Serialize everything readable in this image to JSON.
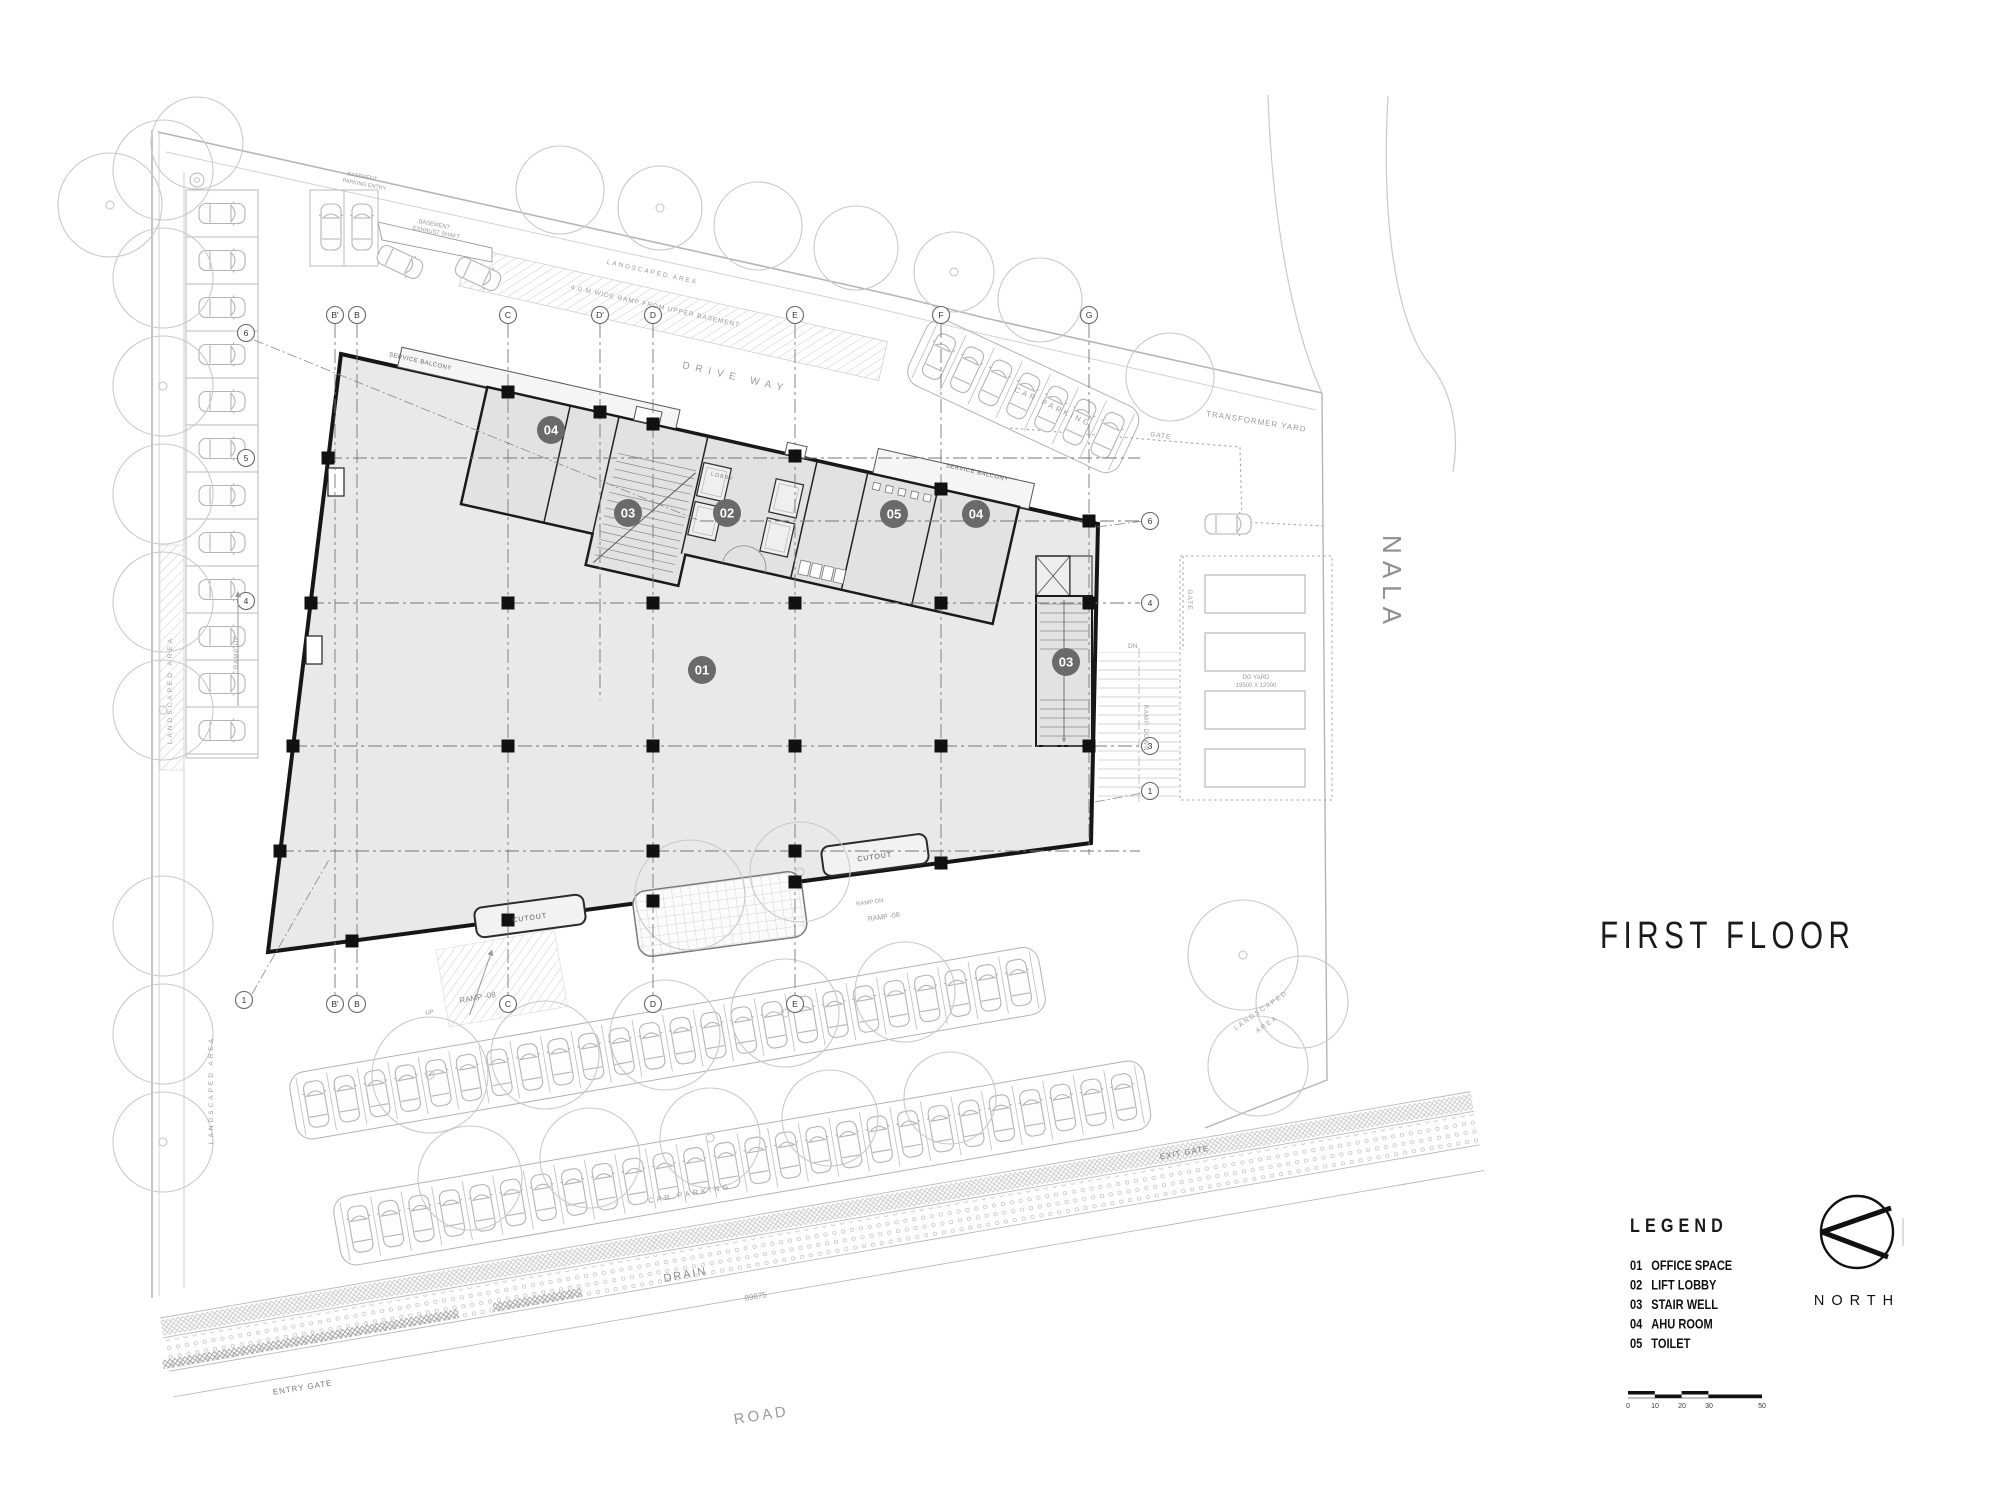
{
  "title": "FIRST FLOOR",
  "legend": {
    "title": "LEGEND",
    "items": [
      {
        "num": "01",
        "label": "OFFICE SPACE"
      },
      {
        "num": "02",
        "label": "LIFT LOBBY"
      },
      {
        "num": "03",
        "label": "STAIR WELL"
      },
      {
        "num": "04",
        "label": "AHU ROOM"
      },
      {
        "num": "05",
        "label": "TOILET"
      }
    ]
  },
  "north": {
    "label": "NORTH"
  },
  "scale_bar": {
    "ticks": [
      "0",
      "10",
      "20",
      "30",
      "50"
    ]
  },
  "grid": {
    "top_letters": [
      "B'",
      "B",
      "C",
      "D'",
      "D",
      "E",
      "F",
      "G"
    ],
    "bottom_letters": [
      "B'",
      "B",
      "C",
      "D",
      "E"
    ],
    "left_numbers": [
      "6",
      "5",
      "4",
      "1"
    ],
    "right_numbers": [
      "6",
      "4",
      "3",
      "1"
    ]
  },
  "room_badges": [
    "04",
    "03",
    "02",
    "05",
    "04",
    "01",
    "03"
  ],
  "labels": {
    "drive_way": "DRIVE WAY",
    "car_parking_top": "CAR PARKING",
    "car_parking_bottom": "CAR PARKING",
    "nala": "NALA",
    "road": "ROAD",
    "drain": "DRAIN",
    "dimension": "89875",
    "entry_gate": "ENTRY GATE",
    "exit_gate": "EXIT GATE",
    "gate_fence": "GATE",
    "gate_side": "GATE",
    "transformer_yard": "TRANSFORMER YARD",
    "dg_yard_1": "DG YARD",
    "dg_yard_2": "19500 X 12000",
    "landscaped_left": "LANDSCAPED AREA",
    "landscaped_lower_left": "LANDSCAPED AREA",
    "landscaped_top": "LANDSCAPED AREA",
    "landscaped_right_1": "LANDSCAPED",
    "landscaped_right_2": "AREA",
    "basement_shaft_1": "BASEMENT",
    "basement_shaft_2": "EXHAUST SHAFT",
    "basement_entry_1": "BASEMENT",
    "basement_entry_2": "PARKING ENTRY",
    "ramp_upper_basement": "4.0 M WIDE RAMP FROM UPPER BASEMENT",
    "service_balcony_left": "SERVICE BALCONY",
    "service_balcony_right": "SERVICE BALCONY",
    "lobby": "LOBBY",
    "cutout_a": "CUTOUT",
    "cutout_c": "CUTOUT",
    "ramp_08_left": "RAMP -08",
    "ramp_up_left": "UP",
    "ramp_08_mid": "RAMP -08",
    "ramp_dn_mid": "RAMP DN",
    "ramp_down_right": "RAMP DOWN",
    "dn_right": "DN",
    "ramp_up_side": "RAMP UP"
  }
}
